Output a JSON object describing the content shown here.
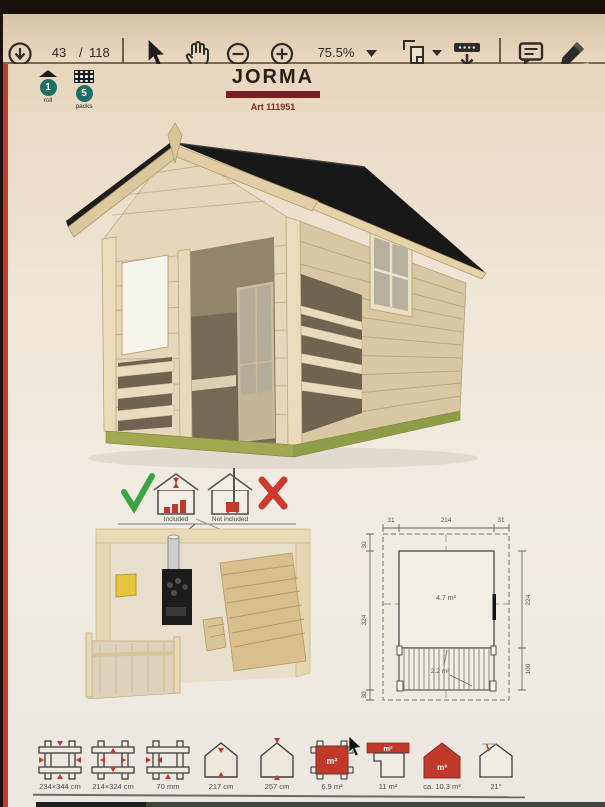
{
  "toolbar": {
    "page_current": "43",
    "page_divider": "/",
    "page_total": "118",
    "zoom_level": "75.5%",
    "icons": [
      "download-icon",
      "select-cursor-icon",
      "hand-tool-icon",
      "zoom-out-icon",
      "zoom-in-icon",
      "page-fit-icon",
      "save-to-device-icon",
      "comment-icon",
      "pen-icon"
    ]
  },
  "page": {
    "product_title": "JORMA",
    "art_number": "Art 111951",
    "packaging": {
      "roll_count": "1",
      "roll_label": "roll",
      "pack_count": "5",
      "pack_label": "packs"
    },
    "inclusion": {
      "included": "Included",
      "not_included": "Not included"
    },
    "plan": {
      "dim_top_left": "31",
      "dim_top_center": "214",
      "dim_top_right": "31",
      "dim_left_top": "30",
      "dim_left_middle": "324",
      "dim_left_bottom": "30",
      "dim_right_upper": "224",
      "dim_right_lower": "100",
      "area_main": "4.7 m²",
      "area_porch": "2.2 m²"
    },
    "specs": [
      {
        "label": "234×344 cm"
      },
      {
        "label": "214×324 cm"
      },
      {
        "label": "70 mm"
      },
      {
        "label": "217 cm"
      },
      {
        "label": "257 cm"
      },
      {
        "label": "6.9 m²",
        "badge": "m²"
      },
      {
        "label": "11 m²",
        "badge": "m²"
      },
      {
        "label": "ca. 10.3 m³",
        "badge": "m³"
      },
      {
        "label": "21°"
      }
    ],
    "colors": {
      "accent_red": "#c0392b",
      "brand_maroon": "#7b1e23",
      "roof_black": "#181818",
      "wood": "#e6d7ba",
      "base_green": "#a0a852",
      "check_green": "#3aa343"
    }
  }
}
